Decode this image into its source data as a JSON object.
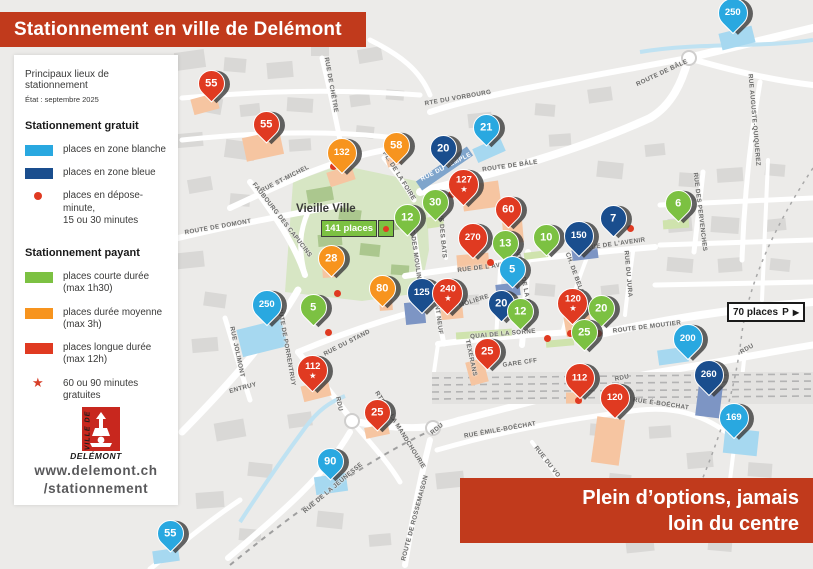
{
  "header": {
    "title": "Stationnement en ville de Delémont",
    "subtitle": "Principaux lieux de stationnement",
    "status_note": "État : septembre 2025"
  },
  "legend": {
    "free": {
      "title": "Stationnement gratuit",
      "items": [
        {
          "kind": "swatch",
          "color": "#29a8e0",
          "lines": [
            "places en zone blanche"
          ]
        },
        {
          "kind": "swatch",
          "color": "#1a4e8e",
          "lines": [
            "places en zone bleue"
          ]
        },
        {
          "kind": "dot",
          "color": "#e03a21",
          "lines": [
            "places en dépose-minute,",
            "15 ou 30 minutes"
          ]
        }
      ]
    },
    "paid": {
      "title": "Stationnement payant",
      "items": [
        {
          "kind": "swatch",
          "color": "#7cc142",
          "lines": [
            "places courte durée",
            "(max 1h30)"
          ]
        },
        {
          "kind": "swatch",
          "color": "#f7941e",
          "lines": [
            "places durée moyenne",
            "(max 3h)"
          ]
        },
        {
          "kind": "swatch",
          "color": "#e03a21",
          "lines": [
            "places longue durée",
            "(max 12h)"
          ]
        },
        {
          "kind": "star",
          "color": "#d7402a",
          "lines": [
            "60 ou 90 minutes",
            "gratuites"
          ]
        }
      ]
    }
  },
  "footer": {
    "logo_vertical": "VILLE DE",
    "logo_name": "DELÉMONT",
    "website_line1": "www.delemont.ch",
    "website_line2": "/stationnement"
  },
  "banner": {
    "line1": "Plein d’options, jamais",
    "line2": "loin du centre"
  },
  "map": {
    "old_town_label": "Vieille Ville",
    "old_town_places": "141 places",
    "sign_70": {
      "places": "70 places",
      "symbol": "P",
      "arrow": "▶"
    },
    "pins": [
      {
        "n": "250",
        "c": "lb",
        "x": 733,
        "y": 13
      },
      {
        "n": "55",
        "c": "r",
        "x": 211,
        "y": 83
      },
      {
        "n": "55",
        "c": "r",
        "x": 266,
        "y": 124
      },
      {
        "n": "132",
        "c": "o",
        "x": 342,
        "y": 153
      },
      {
        "n": "58",
        "c": "o",
        "x": 396,
        "y": 145
      },
      {
        "n": "21",
        "c": "lb",
        "x": 486,
        "y": 127
      },
      {
        "n": "20",
        "c": "db",
        "x": 443,
        "y": 148
      },
      {
        "n": "127",
        "c": "r",
        "x": 463,
        "y": 184,
        "star": true
      },
      {
        "n": "30",
        "c": "g",
        "x": 435,
        "y": 202
      },
      {
        "n": "60",
        "c": "r",
        "x": 508,
        "y": 209
      },
      {
        "n": "6",
        "c": "g",
        "x": 678,
        "y": 203
      },
      {
        "n": "12",
        "c": "g",
        "x": 407,
        "y": 217
      },
      {
        "n": "7",
        "c": "db",
        "x": 613,
        "y": 218
      },
      {
        "n": "270",
        "c": "r",
        "x": 473,
        "y": 238
      },
      {
        "n": "10",
        "c": "g",
        "x": 546,
        "y": 237
      },
      {
        "n": "150",
        "c": "db",
        "x": 579,
        "y": 236
      },
      {
        "n": "13",
        "c": "g",
        "x": 505,
        "y": 243
      },
      {
        "n": "28",
        "c": "o",
        "x": 331,
        "y": 258
      },
      {
        "n": "5",
        "c": "lb",
        "x": 512,
        "y": 269
      },
      {
        "n": "80",
        "c": "o",
        "x": 382,
        "y": 288
      },
      {
        "n": "125",
        "c": "db",
        "x": 422,
        "y": 293
      },
      {
        "n": "240",
        "c": "r",
        "x": 447,
        "y": 293,
        "star": true
      },
      {
        "n": "250",
        "c": "lb",
        "x": 267,
        "y": 305
      },
      {
        "n": "5",
        "c": "g",
        "x": 313,
        "y": 307
      },
      {
        "n": "20",
        "c": "db",
        "x": 501,
        "y": 303
      },
      {
        "n": "120",
        "c": "r",
        "x": 572,
        "y": 303,
        "star": true
      },
      {
        "n": "20",
        "c": "g",
        "x": 601,
        "y": 308
      },
      {
        "n": "12",
        "c": "g",
        "x": 520,
        "y": 311
      },
      {
        "n": "25",
        "c": "g",
        "x": 584,
        "y": 332
      },
      {
        "n": "200",
        "c": "lb",
        "x": 688,
        "y": 339
      },
      {
        "n": "25",
        "c": "r",
        "x": 487,
        "y": 351
      },
      {
        "n": "112",
        "c": "r",
        "x": 312,
        "y": 370,
        "star": true
      },
      {
        "n": "112",
        "c": "r",
        "x": 580,
        "y": 378
      },
      {
        "n": "260",
        "c": "db",
        "x": 709,
        "y": 375
      },
      {
        "n": "120",
        "c": "r",
        "x": 615,
        "y": 398
      },
      {
        "n": "25",
        "c": "r",
        "x": 377,
        "y": 412
      },
      {
        "n": "169",
        "c": "lb",
        "x": 734,
        "y": 418
      },
      {
        "n": "90",
        "c": "lb",
        "x": 330,
        "y": 461
      },
      {
        "n": "55",
        "c": "lb",
        "x": 170,
        "y": 533
      }
    ],
    "drop_dots": [
      {
        "x": 333,
        "y": 166
      },
      {
        "x": 451,
        "y": 194
      },
      {
        "x": 630,
        "y": 228
      },
      {
        "x": 490,
        "y": 262
      },
      {
        "x": 337,
        "y": 293
      },
      {
        "x": 328,
        "y": 332
      },
      {
        "x": 547,
        "y": 338
      },
      {
        "x": 570,
        "y": 333
      },
      {
        "x": 598,
        "y": 333
      },
      {
        "x": 578,
        "y": 400
      }
    ],
    "street_labels": [
      {
        "name": "RUE DE CHÊTRE",
        "x": 331,
        "y": 85,
        "rot": 80
      },
      {
        "name": "RTE DU VORBOURG",
        "x": 458,
        "y": 98,
        "rot": -10
      },
      {
        "name": "ROUTE DE BÂLE",
        "x": 662,
        "y": 73,
        "rot": -25
      },
      {
        "name": "RUE AUGUSTE-QUIQUEREZ",
        "x": 754,
        "y": 120,
        "rot": 85
      },
      {
        "name": "ROUTE DE BÂLE",
        "x": 510,
        "y": 166,
        "rot": -8
      },
      {
        "name": "RUE ST-MICHEL",
        "x": 285,
        "y": 179,
        "rot": -27
      },
      {
        "name": "FAUBOURG DES CAPUCINS",
        "x": 282,
        "y": 220,
        "rot": 52
      },
      {
        "name": "ROUTE DE DOMONT",
        "x": 218,
        "y": 227,
        "rot": -10
      },
      {
        "name": "PL. DE LA FOIRE",
        "x": 399,
        "y": 176,
        "rot": 58
      },
      {
        "name": "RUE DU TEMPLE",
        "x": 446,
        "y": 167,
        "rot": -27,
        "white": true
      },
      {
        "name": "RUE DES MOULINS",
        "x": 415,
        "y": 252,
        "rot": 82
      },
      {
        "name": "RUE DES BATS",
        "x": 442,
        "y": 233,
        "rot": 85
      },
      {
        "name": "RUE DE L'AVENIR",
        "x": 487,
        "y": 267,
        "rot": -7
      },
      {
        "name": "RUE DE L'AVENIR",
        "x": 616,
        "y": 244,
        "rot": -8
      },
      {
        "name": "AVENUE DE LA GARE",
        "x": 524,
        "y": 283,
        "rot": 78
      },
      {
        "name": "CH. DE BELLEVOIE",
        "x": 578,
        "y": 283,
        "rot": 70
      },
      {
        "name": "RUE DU JURA",
        "x": 628,
        "y": 274,
        "rot": 85
      },
      {
        "name": "MOLIÈRE",
        "x": 474,
        "y": 301,
        "rot": -18
      },
      {
        "name": "QUAI DE LA SORNE",
        "x": 503,
        "y": 334,
        "rot": -5
      },
      {
        "name": "GARE CFF",
        "x": 520,
        "y": 363,
        "rot": -8
      },
      {
        "name": "TEXERANS",
        "x": 471,
        "y": 358,
        "rot": 78
      },
      {
        "name": "ROUTE DE MOUTIER",
        "x": 647,
        "y": 327,
        "rot": -7
      },
      {
        "name": "RDU",
        "x": 622,
        "y": 378,
        "rot": -12
      },
      {
        "name": "RDU",
        "x": 747,
        "y": 349,
        "rot": -30
      },
      {
        "name": "RDU",
        "x": 339,
        "y": 404,
        "rot": 78
      },
      {
        "name": "RDU",
        "x": 437,
        "y": 429,
        "rot": -40
      },
      {
        "name": "RUE ÉMILE-BOÉCHAT",
        "x": 500,
        "y": 430,
        "rot": -10
      },
      {
        "name": "RUE DU VO",
        "x": 547,
        "y": 462,
        "rot": 52
      },
      {
        "name": "RUE É-BOÉCHAT",
        "x": 661,
        "y": 404,
        "rot": 8
      },
      {
        "name": "ROUTE DE PORRENTRUY",
        "x": 286,
        "y": 344,
        "rot": 80
      },
      {
        "name": "ENTRUY",
        "x": 243,
        "y": 388,
        "rot": -15
      },
      {
        "name": "RUE JOLIMONT",
        "x": 237,
        "y": 352,
        "rot": 78
      },
      {
        "name": "RUE DU STAND",
        "x": 347,
        "y": 343,
        "rot": -27
      },
      {
        "name": "PONT NEUF",
        "x": 438,
        "y": 315,
        "rot": 82
      },
      {
        "name": "RTE DE LA MANDCHOURIE",
        "x": 400,
        "y": 430,
        "rot": 58
      },
      {
        "name": "RUE DE LA JEUNESSE",
        "x": 333,
        "y": 488,
        "rot": -40
      },
      {
        "name": "ROUTE DE ROSSEMAISON",
        "x": 415,
        "y": 518,
        "rot": -75
      },
      {
        "name": "RUE DES PERVENCHES",
        "x": 700,
        "y": 212,
        "rot": 83
      }
    ]
  },
  "colors": {
    "banner_red": "#c13a1c",
    "pin_red": "#e03a21",
    "pin_orange": "#f7941e",
    "pin_green": "#7cc142",
    "pin_lightblue": "#29a8e0",
    "pin_darkblue": "#1a4e8e",
    "zone_salmon": "#f6c5a1",
    "zone_lightblue": "#a6d8f0",
    "zone_darkblue": "#7d95c4",
    "zone_green": "#cfe3ad",
    "old_town_green": "#d7e6c4"
  }
}
